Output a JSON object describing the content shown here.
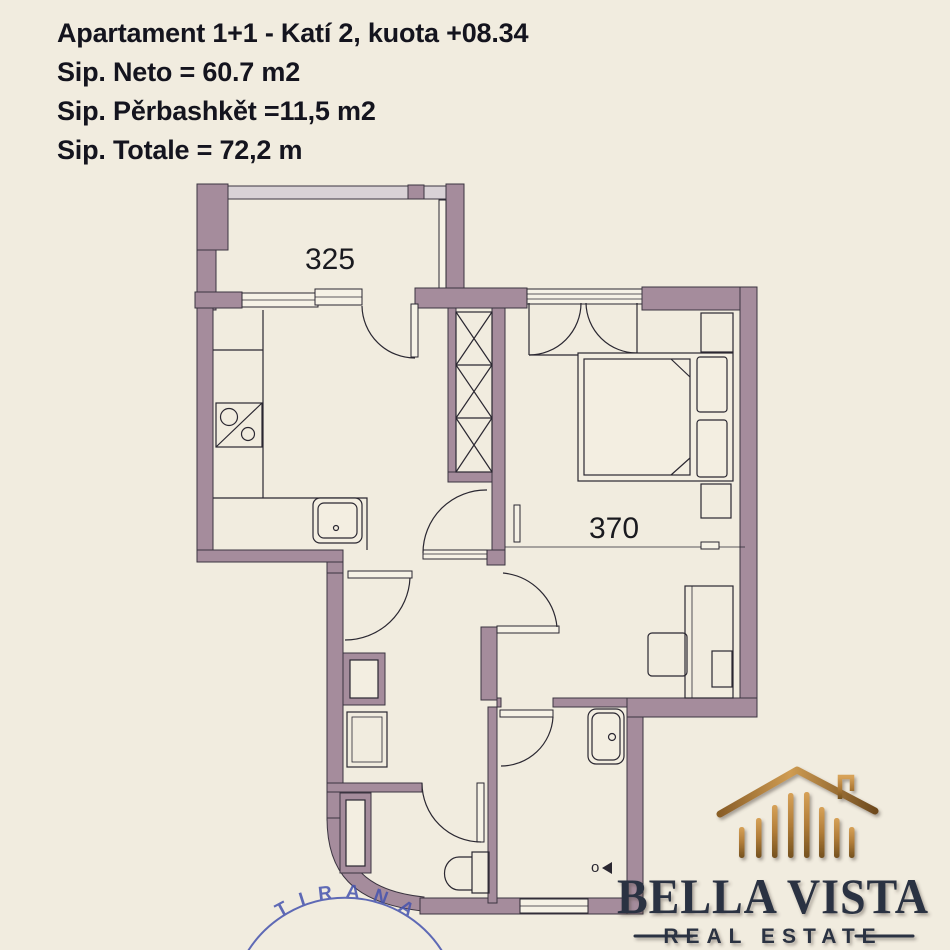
{
  "header": {
    "title": "Apartament 1+1 - Katí 2, kuota +08.34",
    "area_net": "Sip. Neto = 60.7 m2",
    "area_common": "Sip. Pěrbashkět =11,5 m2",
    "area_total": "Sip. Totale = 72,2 m"
  },
  "floorplan": {
    "balcony_width_label": "325",
    "bedroom_width_label": "370",
    "drain_marker": "o"
  },
  "logo": {
    "company": "BELLA VISTA",
    "tagline": "REAL ESTATE"
  },
  "stamp": {
    "text": "TIRANA"
  },
  "colors": {
    "background": "#f1ecdf",
    "wall": "#a58c9c",
    "railing": "#d9d2d6",
    "line": "#2a2731",
    "title_text": "#14141e",
    "logo_gold": "#b27c3e",
    "logo_navy": "#2b3342",
    "stamp_blue": "#4553ae"
  }
}
